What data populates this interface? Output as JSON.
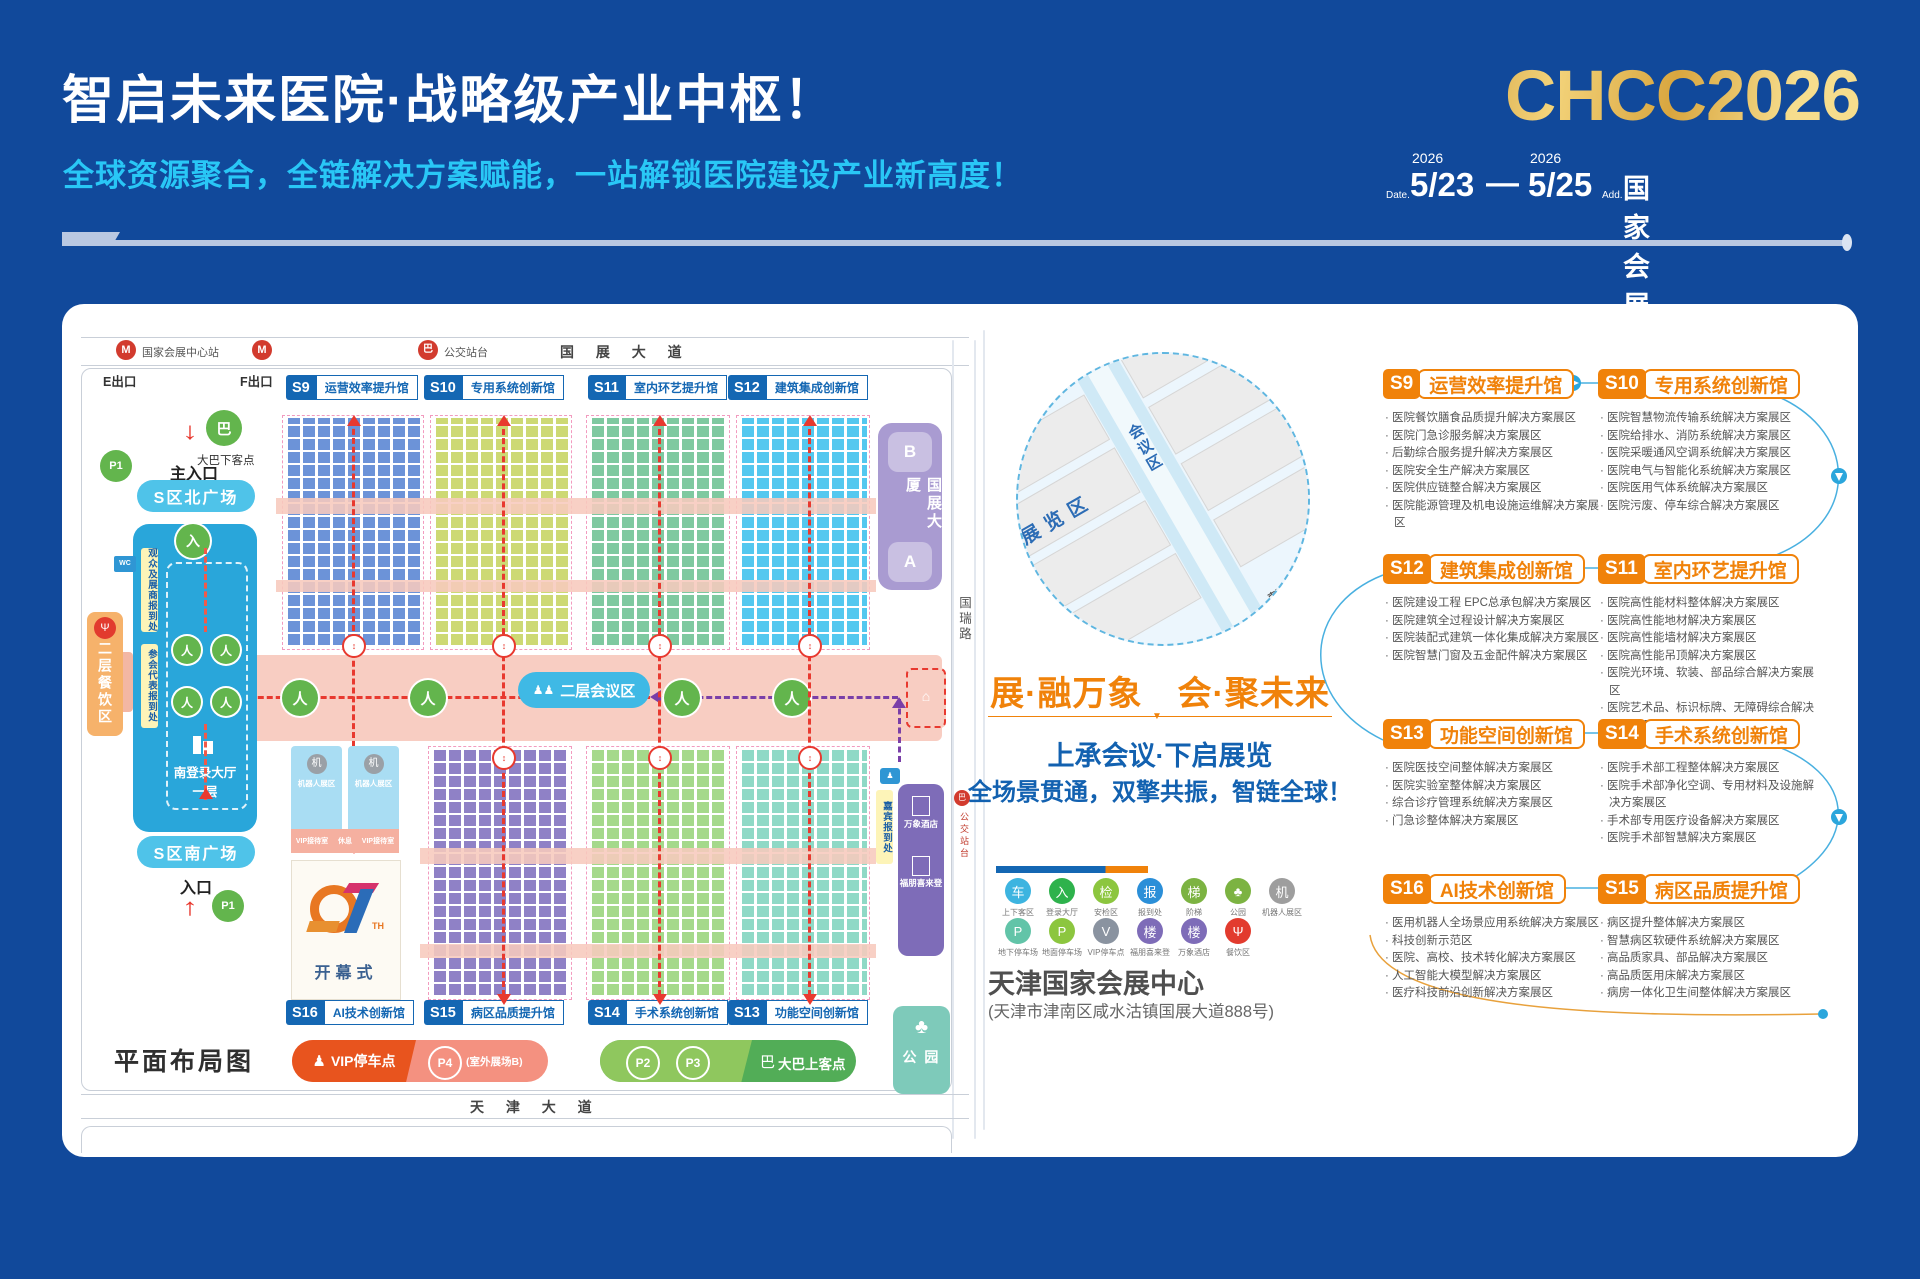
{
  "colors": {
    "bg": "#11499b",
    "accent_cyan": "#29c7f6",
    "accent_orange": "#f0820a",
    "gold": "#d9a63f",
    "map_blue": "#1467b3",
    "red": "#e8392f"
  },
  "header": {
    "title": "智启未来医院·战略级产业中枢！",
    "subtitle": "全球资源聚合，全链解决方案赋能，一站解锁医院建设产业新高度！",
    "logo": "CHCC2026",
    "date_label": "Date.",
    "year1": "2026",
    "date_start": "5/23",
    "date_sep": "—",
    "year2": "2026",
    "date_end": "5/25",
    "addr_label": "Add.",
    "address": "国家会展中心(天津)"
  },
  "map": {
    "roads": {
      "top": "国 展 大 道",
      "bottom": "天 津 大 道",
      "right": "国瑞路",
      "metro_station": "国家会展中心站",
      "bus_stop": "公交站台",
      "bus_stop_right": "公交站台"
    },
    "exits": {
      "e": "E出口",
      "f": "F出口",
      "top": "出口",
      "bottom": "出口",
      "main_entrance": "主入口",
      "entrance": "入口"
    },
    "halls_top": [
      {
        "id": "S9",
        "name": "运营效率提升馆"
      },
      {
        "id": "S10",
        "name": "专用系统创新馆"
      },
      {
        "id": "S11",
        "name": "室内环艺提升馆"
      },
      {
        "id": "S12",
        "name": "建筑集成创新馆"
      }
    ],
    "halls_bottom": [
      {
        "id": "S16",
        "name": "AI技术创新馆"
      },
      {
        "id": "S15",
        "name": "病区品质提升馆"
      },
      {
        "id": "S14",
        "name": "手术系统创新馆"
      },
      {
        "id": "S13",
        "name": "功能空间创新馆"
      }
    ],
    "left_zone": {
      "bus_drop": "大巴下客点",
      "p1": "P1",
      "north_plaza": "S区北广场",
      "reg1": "观众及展商报到处",
      "reg2": "参会代表报到处",
      "dining": "二层餐饮区",
      "hall_name": "南登录大厅",
      "hall_floor": "一层",
      "south_plaza": "S区南广场",
      "wc": "WC"
    },
    "center": {
      "conference": "二层会议区"
    },
    "right_zone": {
      "tower_b": "B",
      "building": "国展大厦",
      "tower_a": "A",
      "guest_reg": "嘉宾报到处",
      "hotel1": "万象酒店",
      "hotel2": "福朋喜来登",
      "park": "公 园"
    },
    "opening": {
      "num_th": "TH",
      "label": "开幕式",
      "robot": "机器人展区",
      "vip_room": "VIP接待室",
      "rest": "休息"
    },
    "legend": {
      "vip": "VIP停车点",
      "p4": "P4",
      "p4_sub": "(室外展场B)",
      "p2": "P2",
      "p3": "P3",
      "bus_up": "大巴上客点"
    },
    "caption": "平面布局图"
  },
  "middle": {
    "circle": {
      "halls_left": [
        {
          "id": "S12"
        },
        {
          "id": "S11"
        },
        {
          "id": "S10"
        },
        {
          "id": "S9"
        }
      ],
      "halls_right": [
        {
          "id": "S13"
        },
        {
          "id": "S14"
        },
        {
          "id": "S15"
        },
        {
          "id": "S16"
        }
      ],
      "exhibit": "展览区",
      "conference": "会议区",
      "hall2": "南登录厅二层",
      "hall1": "南登录厅一层",
      "entrance": "主入口",
      "dining": "餐饮区",
      "hotel1": "万象酒店",
      "hotel2": "福朋喜来登"
    },
    "slogan": "展·融万象　会·聚未来",
    "line1": "上承会议·下启展览",
    "line2": "全场景贯通，双擎共振，智链全球！",
    "legend_row1": [
      {
        "label": "上下客区",
        "glyph": "车",
        "color": "#3db4e0"
      },
      {
        "label": "登录大厅",
        "glyph": "入",
        "color": "#2eb24c"
      },
      {
        "label": "安检区",
        "glyph": "检",
        "color": "#8cc63f"
      },
      {
        "label": "报到处",
        "glyph": "报",
        "color": "#2b8fd8"
      },
      {
        "label": "阶梯",
        "glyph": "梯",
        "color": "#7cb342"
      },
      {
        "label": "公园",
        "glyph": "♣",
        "color": "#7cb342"
      },
      {
        "label": "机器人展区",
        "glyph": "机",
        "color": "#9e9e9e"
      }
    ],
    "legend_row2": [
      {
        "label": "地下停车场",
        "glyph": "P",
        "color": "#62c4a8"
      },
      {
        "label": "地面停车场",
        "glyph": "P",
        "color": "#8cc63f"
      },
      {
        "label": "VIP停车点",
        "glyph": "V",
        "color": "#8a93a0"
      },
      {
        "label": "福朋喜来登",
        "glyph": "楼",
        "color": "#7e6cb8"
      },
      {
        "label": "万象酒店",
        "glyph": "楼",
        "color": "#7e6cb8"
      },
      {
        "label": "餐饮区",
        "glyph": "Ψ",
        "color": "#e23b2e"
      }
    ],
    "venue": "天津国家会展中心",
    "venue_addr": "(天津市津南区咸水沽镇国展大道888号)"
  },
  "sections": [
    {
      "id": "S9",
      "name": "运营效率提升馆",
      "items": [
        "医院餐饮膳食品质提升解决方案展区",
        "医院门急诊服务解决方案展区",
        "后勤综合服务提升解决方案展区",
        "医院安全生产解决方案展区",
        "医院供应链整合解决方案展区",
        "医院能源管理及机电设施运维解决方案展区"
      ]
    },
    {
      "id": "S10",
      "name": "专用系统创新馆",
      "items": [
        "医院智慧物流传输系统解决方案展区",
        "医院给排水、消防系统解决方案展区",
        "医院采暖通风空调系统解决方案展区",
        "医院电气与智能化系统解决方案展区",
        "医院医用气体系统解决方案展区",
        "医院污废、停车综合解决方案展区"
      ]
    },
    {
      "id": "S12",
      "name": "建筑集成创新馆",
      "items": [
        "医院建设工程 EPC总承包解决方案展区",
        "医院建筑全过程设计解决方案展区",
        "医院装配式建筑一体化集成解决方案展区",
        "医院智慧门窗及五金配件解决方案展区"
      ]
    },
    {
      "id": "S11",
      "name": "室内环艺提升馆",
      "items": [
        "医院高性能材料整体解决方案展区",
        "医院高性能地材解决方案展区",
        "医院高性能墙材解决方案展区",
        "医院高性能吊顶解决方案展区",
        "医院光环境、软装、部品综合解决方案展区",
        "医院艺术品、标识标牌、无障碍综合解决方案展区"
      ]
    },
    {
      "id": "S13",
      "name": "功能空间创新馆",
      "items": [
        "医院医技空间整体解决方案展区",
        "医院实验室整体解决方案展区",
        "综合诊疗管理系统解决方案展区",
        "门急诊整体解决方案展区"
      ]
    },
    {
      "id": "S14",
      "name": "手术系统创新馆",
      "items": [
        "医院手术部工程整体解决方案展区",
        "医院手术部净化空调、专用材料及设施解决方案展区",
        "手术部专用医疗设备解决方案展区",
        "医院手术部智慧解决方案展区"
      ]
    },
    {
      "id": "S16",
      "name": "AI技术创新馆",
      "items": [
        "医用机器人全场景应用系统解决方案展区",
        "科技创新示范区",
        "医院、高校、技术转化解决方案展区",
        "人工智能大模型解决方案展区",
        "医疗科技前沿创新解决方案展区"
      ]
    },
    {
      "id": "S15",
      "name": "病区品质提升馆",
      "items": [
        "病区提升整体解决方案展区",
        "智慧病区软硬件系统解决方案展区",
        "高品质家具、部品解决方案展区",
        "高品质医用床解决方案展区",
        "病房一体化卫生间整体解决方案展区"
      ]
    }
  ]
}
